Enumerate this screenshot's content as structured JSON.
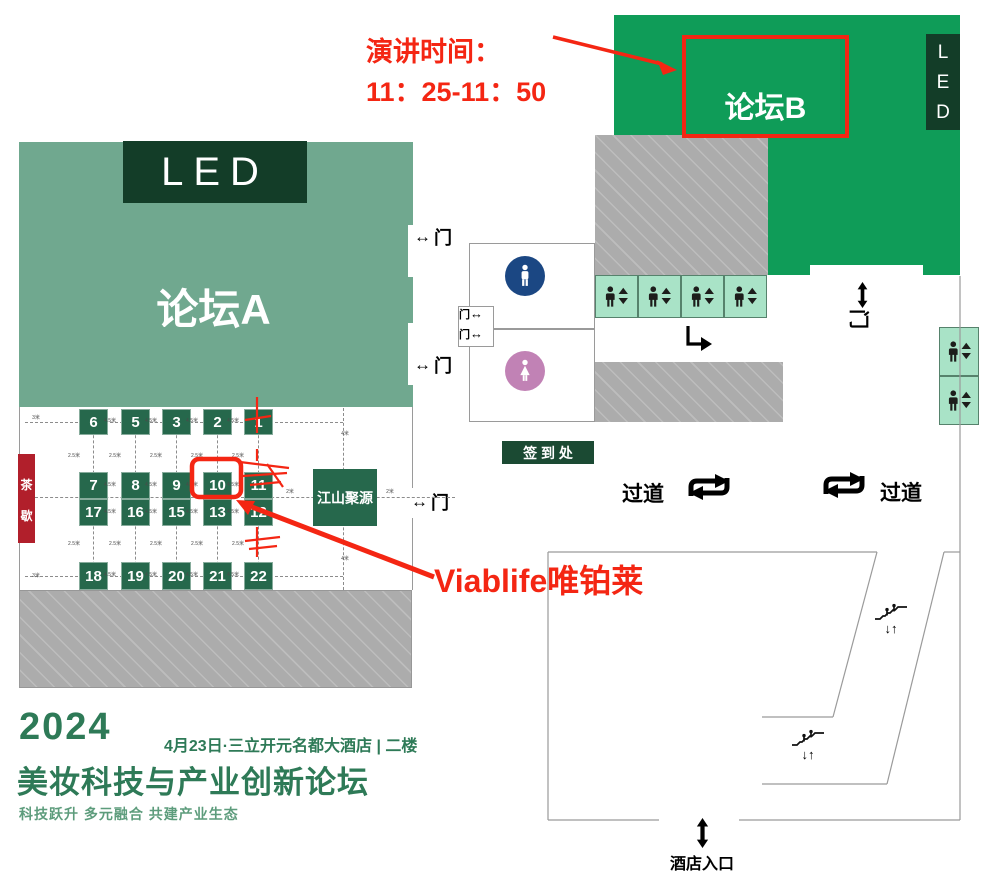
{
  "annotation": {
    "line1": "演讲时间：",
    "line2": "11：25-11：50",
    "callout": "Viablife唯铂莱"
  },
  "forum_a": {
    "name": "论坛A",
    "led": "LED"
  },
  "forum_b": {
    "name": "论坛B",
    "led_vertical": [
      "L",
      "E",
      "D"
    ]
  },
  "booths": {
    "row1": [
      "6",
      "5",
      "3",
      "2",
      "1"
    ],
    "row2": [
      "7",
      "8",
      "9",
      "10",
      "11"
    ],
    "row3": [
      "17",
      "16",
      "15",
      "13",
      "12"
    ],
    "row4": [
      "18",
      "19",
      "20",
      "21",
      "22"
    ],
    "large": "江山聚源"
  },
  "labels": {
    "tea_break": "茶歇",
    "sign_in": "签 到 处",
    "aisle": "过道",
    "door": "门",
    "hotel_entrance": "酒店入口",
    "down_up": "↓↑"
  },
  "icons": {
    "h_arrow": "↔",
    "v_arrow": "↕"
  },
  "footer": {
    "year": "2024",
    "date_venue": "4月23日·三立开元名都大酒店 | 二楼",
    "title": "美妆科技与产业创新论坛",
    "slogan": "科技跃升 多元融合 共建产业生态"
  },
  "dim_labels": [
    {
      "x": 36,
      "y": 414,
      "t": "3米"
    },
    {
      "x": 36,
      "y": 572,
      "t": "3米"
    },
    {
      "x": 110,
      "y": 417,
      "t": "4.5米"
    },
    {
      "x": 151,
      "y": 417,
      "t": "4.5米"
    },
    {
      "x": 192,
      "y": 417,
      "t": "4.5米"
    },
    {
      "x": 233,
      "y": 417,
      "t": "4.5米"
    },
    {
      "x": 110,
      "y": 481,
      "t": "4.5米"
    },
    {
      "x": 151,
      "y": 481,
      "t": "4.5米"
    },
    {
      "x": 192,
      "y": 481,
      "t": "4.5米"
    },
    {
      "x": 233,
      "y": 481,
      "t": "4.5米"
    },
    {
      "x": 110,
      "y": 508,
      "t": "4.5米"
    },
    {
      "x": 151,
      "y": 508,
      "t": "4.5米"
    },
    {
      "x": 192,
      "y": 508,
      "t": "4.5米"
    },
    {
      "x": 233,
      "y": 508,
      "t": "4.5米"
    },
    {
      "x": 110,
      "y": 571,
      "t": "4.5米"
    },
    {
      "x": 151,
      "y": 571,
      "t": "4.5米"
    },
    {
      "x": 192,
      "y": 571,
      "t": "4.5米"
    },
    {
      "x": 233,
      "y": 571,
      "t": "4.5米"
    },
    {
      "x": 74,
      "y": 452,
      "t": "2.5米"
    },
    {
      "x": 115,
      "y": 452,
      "t": "2.5米"
    },
    {
      "x": 156,
      "y": 452,
      "t": "2.5米"
    },
    {
      "x": 197,
      "y": 452,
      "t": "2.5米"
    },
    {
      "x": 238,
      "y": 452,
      "t": "2.5米"
    },
    {
      "x": 74,
      "y": 540,
      "t": "2.5米"
    },
    {
      "x": 115,
      "y": 540,
      "t": "2.5米"
    },
    {
      "x": 156,
      "y": 540,
      "t": "2.5米"
    },
    {
      "x": 197,
      "y": 540,
      "t": "2.5米"
    },
    {
      "x": 238,
      "y": 540,
      "t": "2.5米"
    },
    {
      "x": 345,
      "y": 430,
      "t": "4米"
    },
    {
      "x": 345,
      "y": 555,
      "t": "4米"
    },
    {
      "x": 290,
      "y": 488,
      "t": "2米"
    },
    {
      "x": 390,
      "y": 488,
      "t": "2米"
    }
  ],
  "colors": {
    "forum_a": "#70a88f",
    "forum_b": "#0f9c58",
    "dark_green": "#133d28",
    "booth_green": "#26684c",
    "signin_green": "#1b4a33",
    "mint": "#a9e3c7",
    "tea_red": "#b11f2b",
    "male_blue": "#1b4783",
    "female_pink": "#c182b5",
    "annotation_red": "#f42613",
    "footer_green": "#2e7a57"
  }
}
